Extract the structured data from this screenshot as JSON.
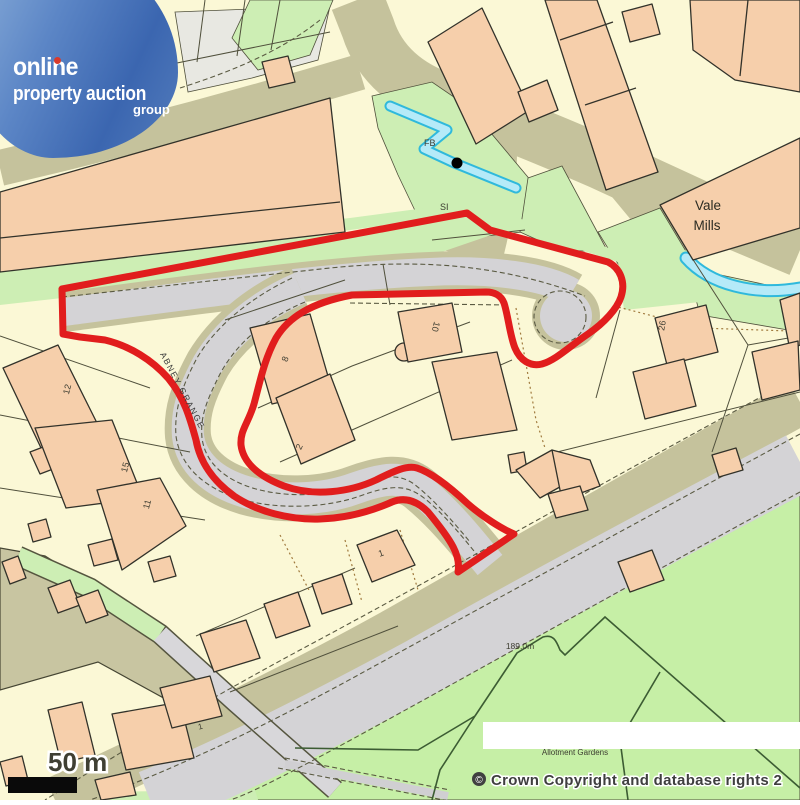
{
  "logo": {
    "brand_line1": "online",
    "brand_line2": "property auction",
    "brand_line3": "group"
  },
  "map_labels": {
    "vale_mills_1": "Vale",
    "vale_mills_2": "Mills",
    "footbridge": "FB",
    "si": "SI",
    "street_name": "ABNEY GRANGE",
    "spot_height": "189.0m",
    "allotment": "Allotment Gardens",
    "house_12": "12",
    "house_15": "15",
    "house_11": "11",
    "house_8": "8",
    "house_2": "2",
    "house_10": "10",
    "house_1": "1",
    "house_1_sw": "1",
    "house_26": "26"
  },
  "scale_bar": {
    "label": "50 m"
  },
  "copyright": {
    "symbol": "©",
    "text": "Crown Copyright and database rights 2"
  },
  "colors": {
    "boundary_red": "#e11d1d",
    "building_peach": "#f6cfab",
    "building_outline": "#32322a",
    "road_gray": "#d4d3d6",
    "verge_khaki": "#c5c29c",
    "green_light": "#cdeeb4",
    "green_field": "#c6efa6",
    "water_fill": "#b5eaf8",
    "water_edge": "#2fb9dc",
    "base_cream": "#fbf8d6",
    "logo_blue_light": "#8db0da",
    "logo_blue_dark": "#3b66b0"
  }
}
